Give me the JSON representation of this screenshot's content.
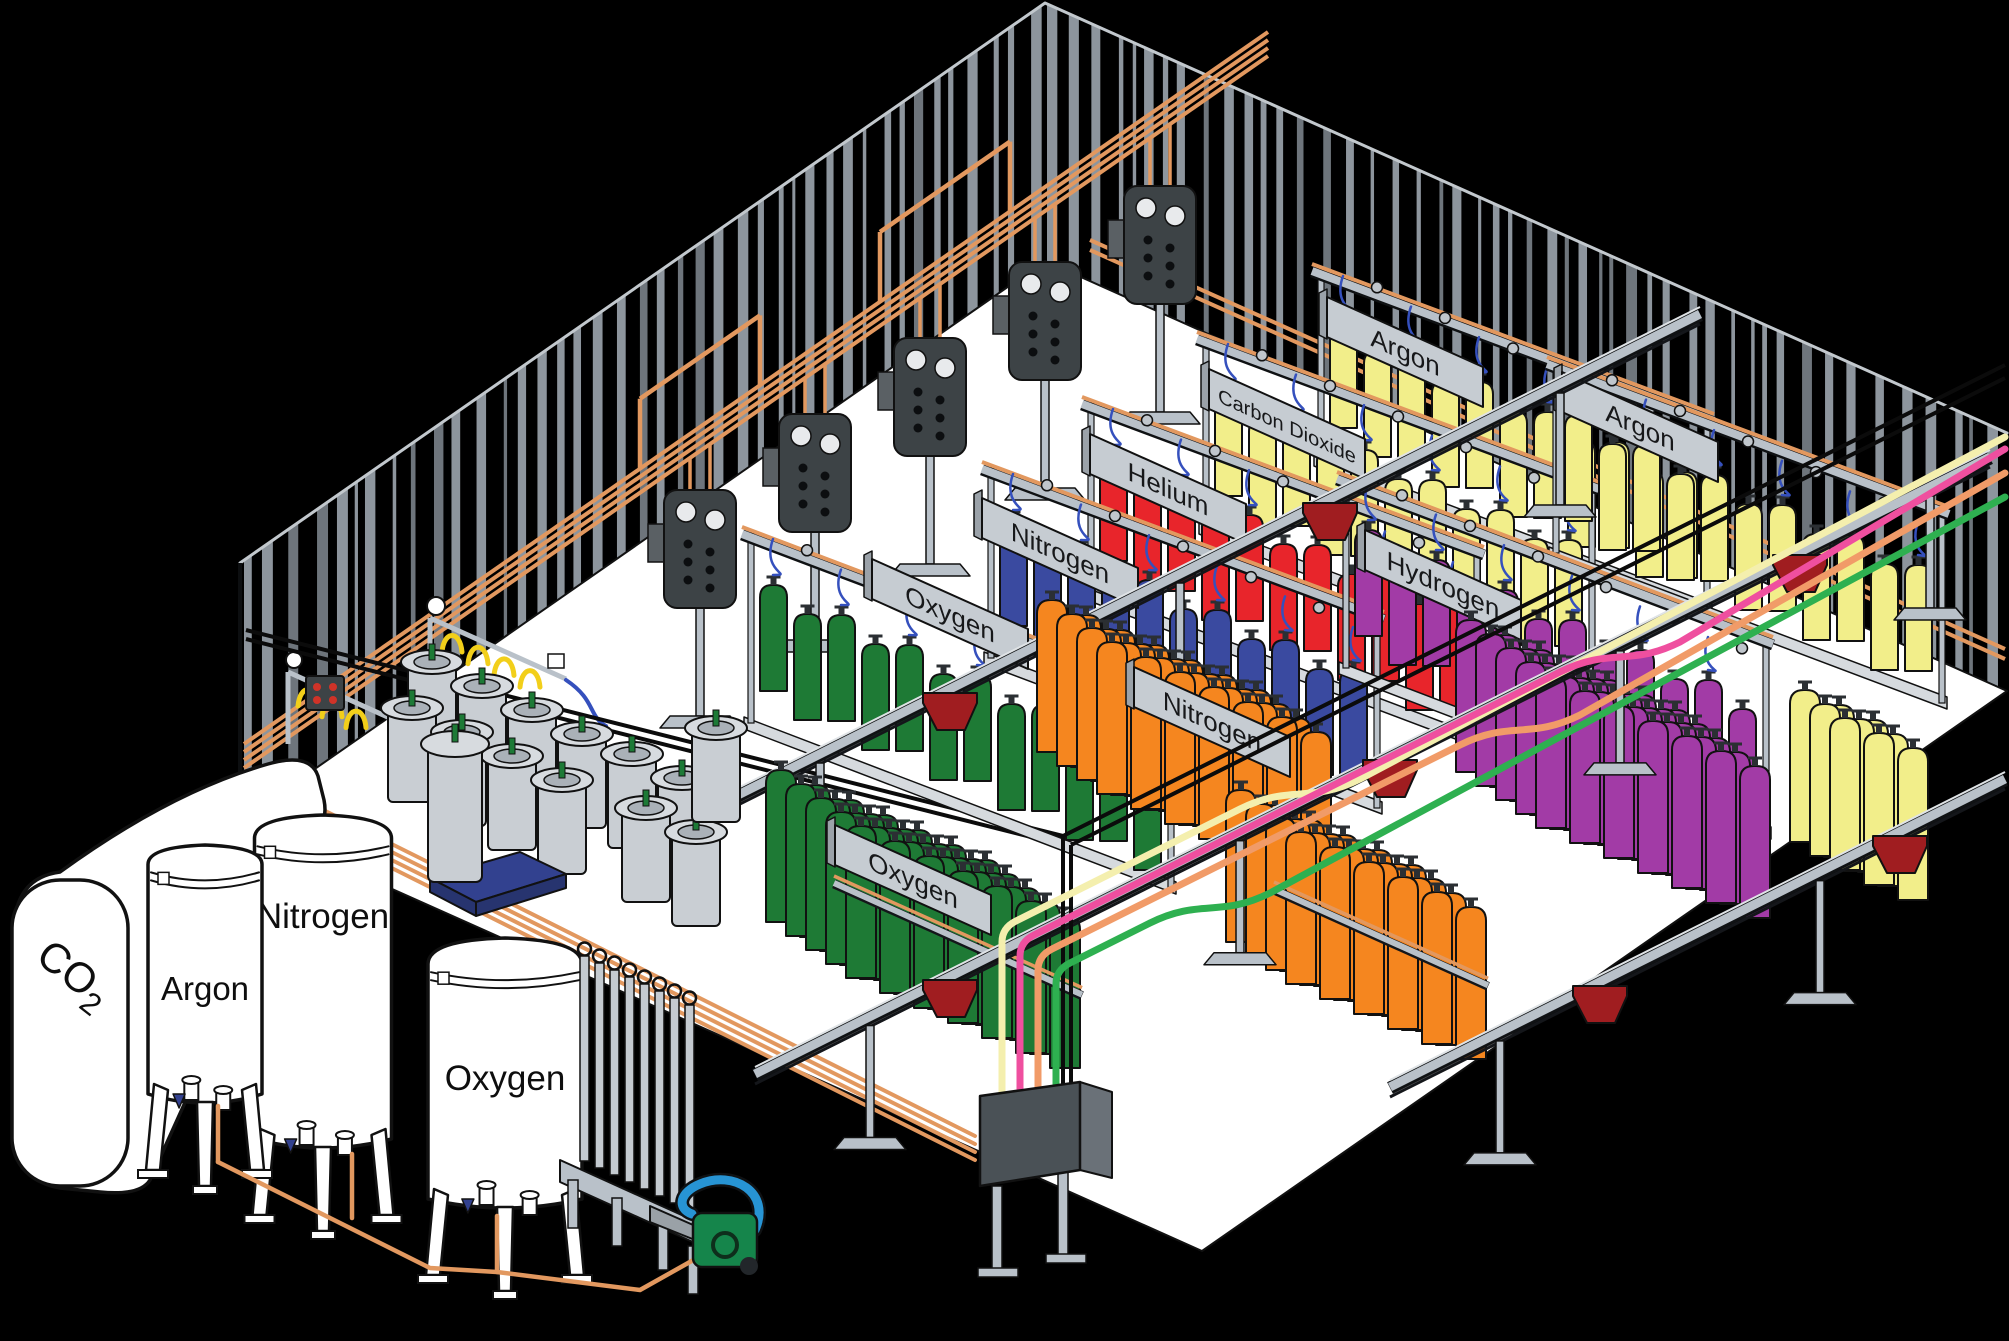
{
  "palette": {
    "background": "#000000",
    "floor": "#ffffff",
    "wall_stripe": "#8d959d",
    "wall_stripe_dark": "#6e757c",
    "roof_edge": "#c2c8cd",
    "outline": "#111111",
    "steel": "#b9c1c9",
    "steel_light": "#d6dade",
    "steel_dark": "#3d4346",
    "copper": "#e2985f",
    "cart_red": "#a01d20",
    "hose_blue": "#3550bd",
    "sign_gray": "#c6ccd2",
    "sign_edge": "#9ba2a9",
    "dewar_gray": "#c9ced3",
    "pallet_blue": "#32418f",
    "valve_green": "#1d7a36",
    "pump_green": "#15854b",
    "pump_blue": "#2794d4",
    "pigtail_yellow": "#f2cf1a",
    "indicator_red": "#d03328",
    "panel_slate": "#4a5156"
  },
  "gas_colors": {
    "oxygen": "#1e7a35",
    "nitrogen": "#3a4aa0",
    "helium": "#e8252b",
    "carbon_dioxide": "#f2ee8a",
    "argon": "#f2ee8a",
    "hydrogen": "#a23ba6",
    "mixed_orange": "#f5861f"
  },
  "supply_line_colors": {
    "cream": "#f4efae",
    "pink": "#ef4f9f",
    "salmon": "#f19b68",
    "green": "#2eb050"
  },
  "signs": [
    {
      "id": "oxygen-1",
      "label": "Oxygen",
      "x": 950,
      "y": 614,
      "fs": 26
    },
    {
      "id": "nitrogen-1",
      "label": "Nitrogen",
      "x": 1060,
      "y": 553,
      "fs": 26
    },
    {
      "id": "helium",
      "label": "Helium",
      "x": 1168,
      "y": 489,
      "fs": 26
    },
    {
      "id": "carbon-dioxide",
      "label": "Carbon Dioxide",
      "x": 1287,
      "y": 424,
      "fs": 20
    },
    {
      "id": "argon-1",
      "label": "Argon",
      "x": 1405,
      "y": 352,
      "fs": 26
    },
    {
      "id": "argon-2",
      "label": "Argon",
      "x": 1640,
      "y": 427,
      "fs": 26
    },
    {
      "id": "hydrogen",
      "label": "Hydrogen",
      "x": 1443,
      "y": 585,
      "fs": 26
    },
    {
      "id": "nitrogen-2",
      "label": "Nitrogen",
      "x": 1212,
      "y": 722,
      "fs": 26
    },
    {
      "id": "oxygen-2",
      "label": "Oxygen",
      "x": 913,
      "y": 880,
      "fs": 26
    }
  ],
  "racks": [
    {
      "id": "argon-1-rack",
      "gas": "argon",
      "sx": 1330,
      "sy": 322,
      "n": 11,
      "sign": 4
    },
    {
      "id": "co2-rack",
      "gas": "carbon_dioxide",
      "sx": 1215,
      "sy": 390,
      "n": 11,
      "sign": 3
    },
    {
      "id": "argon-2-rack",
      "gas": "argon",
      "sx": 1565,
      "sy": 415,
      "n": 11,
      "sign": 5
    },
    {
      "id": "helium-rack",
      "gas": "helium",
      "sx": 1100,
      "sy": 455,
      "n": 11,
      "sign": 2
    },
    {
      "id": "nitrogen-rack",
      "gas": "nitrogen",
      "sx": 1000,
      "sy": 520,
      "n": 11,
      "sign": 1
    },
    {
      "id": "hydrogen-rack",
      "gas": "hydrogen",
      "sx": 1355,
      "sy": 530,
      "n": 12,
      "sign": 6
    },
    {
      "id": "oxygen-rack",
      "gas": "oxygen",
      "sx": 760,
      "sy": 585,
      "n": 12,
      "sign": 0
    }
  ],
  "clusters": [
    {
      "id": "orange-center",
      "gas": "mixed_orange",
      "sx": 1037,
      "sy": 600,
      "cols": 7,
      "rows": 4,
      "bar": false
    },
    {
      "id": "hydrogen-store",
      "gas": "hydrogen",
      "sx": 1456,
      "sy": 620,
      "cols": 7,
      "rows": 5,
      "bar": false
    },
    {
      "id": "argon-store",
      "gas": "argon",
      "sx": 1790,
      "sy": 690,
      "cols": 3,
      "rows": 3,
      "bar": false
    },
    {
      "id": "orange-front",
      "gas": "mixed_orange",
      "sx": 1226,
      "sy": 790,
      "cols": 6,
      "rows": 4,
      "bar": true
    },
    {
      "id": "oxygen-store",
      "gas": "oxygen",
      "sx": 766,
      "sy": 770,
      "cols": 7,
      "rows": 5,
      "bar": true
    }
  ],
  "tanks": [
    {
      "id": "argon",
      "label": "Argon",
      "cx": 205,
      "w": 114,
      "top": 845,
      "bottom": 1100,
      "labelY": 1000,
      "fs": 33
    },
    {
      "id": "nitrogen",
      "label": "Nitrogen",
      "cx": 323,
      "w": 137,
      "top": 815,
      "bottom": 1145,
      "labelY": 928,
      "fs": 35
    },
    {
      "id": "oxygen",
      "label": "Oxygen",
      "cx": 505,
      "w": 154,
      "top": 938,
      "bottom": 1205,
      "labelY": 1090,
      "fs": 35
    }
  ],
  "co2_tank": {
    "label_main": "CO",
    "label_sub": "2",
    "x": 34,
    "y": 960,
    "rotation": 38
  },
  "rails": [
    {
      "x1": 700,
      "y1": 815,
      "x2": 1700,
      "y2": 315,
      "carts": [
        [
          950,
          690
        ],
        [
          1330,
          500
        ]
      ],
      "supports": [
        820,
        1180,
        1560
      ]
    },
    {
      "x1": 755,
      "y1": 1075,
      "x2": 1990,
      "y2": 458,
      "carts": [
        [
          950,
          977
        ],
        [
          1390,
          757
        ],
        [
          1800,
          552
        ]
      ],
      "supports": [
        870,
        1240,
        1620,
        1930
      ]
    },
    {
      "x1": 1390,
      "y1": 1088,
      "x2": 2005,
      "y2": 780,
      "carts": [
        [
          1600,
          983
        ],
        [
          1900,
          833
        ]
      ],
      "supports": [
        1500,
        1820
      ]
    }
  ],
  "manifold_panels": [
    [
      700,
      548
    ],
    [
      815,
      472
    ],
    [
      930,
      396
    ],
    [
      1045,
      320
    ],
    [
      1160,
      244
    ]
  ],
  "dewars": [
    [
      432,
      660
    ],
    [
      482,
      684
    ],
    [
      532,
      708
    ],
    [
      582,
      732
    ],
    [
      412,
      706
    ],
    [
      462,
      730
    ],
    [
      512,
      754
    ],
    [
      562,
      778
    ],
    [
      632,
      752
    ],
    [
      682,
      776
    ],
    [
      646,
      806
    ],
    [
      696,
      830
    ],
    [
      716,
      726
    ]
  ]
}
